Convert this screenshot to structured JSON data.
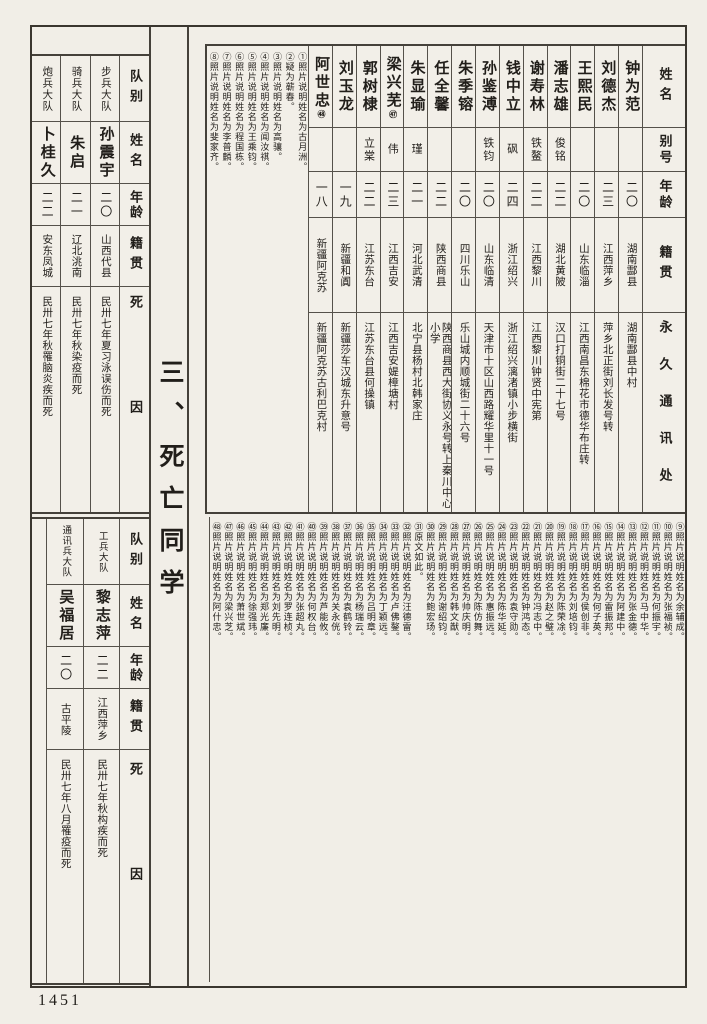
{
  "page": {
    "section_title": "三、死亡同学",
    "page_number": "1451"
  },
  "colors": {
    "paper": "#f1eee7",
    "ink": "#211e1a",
    "line": "#55514a"
  },
  "labels": {
    "name": "姓名",
    "alias": "别号",
    "age": "年龄",
    "native": "籍贯",
    "address": "永久通讯处",
    "unit": "队别",
    "cause": "死因"
  },
  "roster": {
    "persons": [
      {
        "name": "钟为范",
        "mark": "",
        "alias": "",
        "age": "二〇",
        "native": "湖南酃县",
        "address": "湖南酃县中村"
      },
      {
        "name": "刘德杰",
        "mark": "",
        "alias": "",
        "age": "二三",
        "native": "江西萍乡",
        "address": "萍乡北正街刘长发号转"
      },
      {
        "name": "王熙民",
        "mark": "",
        "alias": "",
        "age": "二〇",
        "native": "山东临淄",
        "address": "江西南昌东棉花市德华布庄转"
      },
      {
        "name": "潘志雄",
        "mark": "",
        "alias": "俊铭",
        "age": "二二",
        "native": "湖北黄陂",
        "address": "汉口打铜街二十七号"
      },
      {
        "name": "谢寿林",
        "mark": "",
        "alias": "铁鳌",
        "age": "二二",
        "native": "江西黎川",
        "address": "江西黎川钟贤中宪第"
      },
      {
        "name": "钱中立",
        "mark": "",
        "alias": "砜",
        "age": "二四",
        "native": "浙江绍兴",
        "address": "浙江绍兴漓渚镇小步横街"
      },
      {
        "name": "孙鉴溥",
        "mark": "",
        "alias": "铁钧",
        "age": "二〇",
        "native": "山东临清",
        "address": "天津市十区山西路耀华里十一号"
      },
      {
        "name": "朱季镕",
        "mark": "",
        "alias": "",
        "age": "二〇",
        "native": "四川乐山",
        "address": "乐山城内顺城街二十六号"
      },
      {
        "name": "任全馨",
        "mark": "",
        "alias": "",
        "age": "二二",
        "native": "陕西商县",
        "address": "陕西商县西大街协义永号转上秦川中心小学"
      },
      {
        "name": "朱显瑜",
        "mark": "",
        "alias": "瑾",
        "age": "二一",
        "native": "河北武清",
        "address": "北宁县杨村北韩家庄"
      },
      {
        "name": "梁兴芜",
        "mark": "㊼",
        "alias": "伟",
        "age": "二三",
        "native": "江西吉安",
        "address": "江西吉安媞樟塘村"
      },
      {
        "name": "郭树棣",
        "mark": "",
        "alias": "立棠",
        "age": "二二",
        "native": "江苏东台",
        "address": "江苏东台县何操镇"
      },
      {
        "name": "刘玉龙",
        "mark": "",
        "alias": "",
        "age": "一九",
        "native": "新疆和阗",
        "address": "新疆莎车汉城东升意号"
      },
      {
        "name": "阿世忠",
        "mark": "㊽",
        "alias": "",
        "age": "一八",
        "native": "新疆阿克苏",
        "address": "新疆阿克苏古利巴克村"
      }
    ]
  },
  "top_left_table": {
    "rows": [
      {
        "unit": "步兵大队",
        "name": "孙震宇",
        "age": "二〇",
        "native": "山西代县",
        "cause": "民卅七年夏习泳误伤而死"
      },
      {
        "unit": "骑兵大队",
        "name": "朱启",
        "age": "二一",
        "native": "辽北洮南",
        "cause": "民卅七年秋染疫而死"
      },
      {
        "unit": "炮兵大队",
        "name": "卜桂久",
        "age": "二二",
        "native": "安东凤城",
        "cause": "民卅七年秋罹脑炎疾而死"
      }
    ]
  },
  "bottom_left_table": {
    "rows": [
      {
        "unit": "工兵大队",
        "name": "黎志萍",
        "age": "二二",
        "native": "江西萍乡",
        "cause": "民卅七年秋构疾而死"
      },
      {
        "unit": "通讯兵大队",
        "name": "吴福居",
        "age": "二〇",
        "native": "古平陵",
        "cause": "民卅七年八月罹疫而死"
      }
    ]
  },
  "notes_top": [
    {
      "label": "①照片说明姓名为古月洲。"
    },
    {
      "label": "②疑为蕲春。"
    },
    {
      "label": "③照片说明姓名为高骧。"
    },
    {
      "label": "④照片说明姓名为闻汝祺。"
    },
    {
      "label": "⑤照片说明姓名为王乘钧。"
    },
    {
      "label": "⑥照片说明姓名为程国栋。"
    },
    {
      "label": "⑦照片说明姓名为李普麟。"
    },
    {
      "label": "⑧照片说明姓名为斐家齐。"
    }
  ],
  "notes_bottom": [
    {
      "label": "⑨照片说明姓名为余辅成。"
    },
    {
      "label": "⑩照片说明姓名为张福祯。"
    },
    {
      "label": "⑪照片说明姓名为何振宇。"
    },
    {
      "label": "⑫照片说明姓名为马中华。"
    },
    {
      "label": "⑬照片说明姓名为张金德。"
    },
    {
      "label": "⑭照片说明姓名为阿建中。"
    },
    {
      "label": "⑮照片说明姓名为雷振邦。"
    },
    {
      "label": "⑯照片说明姓名为何子英。"
    },
    {
      "label": "⑰照片说明姓名为侯创非。"
    },
    {
      "label": "⑱照片说明姓名为刘培钧。"
    },
    {
      "label": "⑲照片说明姓名为陈荣凃。"
    },
    {
      "label": "⑳照片说明姓名为赵之璧。"
    },
    {
      "label": "㉑照片说明姓名为冯志中。"
    },
    {
      "label": "㉒照片说明姓名为钟鸿态。"
    },
    {
      "label": "㉓照片说明姓名为袁守勋。"
    },
    {
      "label": "㉔照片说明姓名为陈华延。"
    },
    {
      "label": "㉕照片说明姓名为惠振远。"
    },
    {
      "label": "㉖照片说明姓名为陈仿舞。"
    },
    {
      "label": "㉗照片说明姓名为帅庆明。"
    },
    {
      "label": "㉘照片说明姓名为韩文猷。"
    },
    {
      "label": "㉙照片说明姓名为谢绍钧。"
    },
    {
      "label": "㉚照片说明姓名为鲍宏玚。"
    },
    {
      "label": "㉛原文如此。"
    },
    {
      "label": "㉜照片说明姓名为汪德雷。"
    },
    {
      "label": "㉝照片说明姓名为卢佛鏊。"
    },
    {
      "label": "㉞照片说明姓名为丁颖远。"
    },
    {
      "label": "㉟照片说明姓名为吕明章。"
    },
    {
      "label": "㊱照片说明姓名为杨瑞云。"
    },
    {
      "label": "㊲照片说明姓名为袁鹤铃。"
    },
    {
      "label": "㊳照片说明姓名为关永侊。"
    },
    {
      "label": "㊴照片说明姓名为芦能攸。"
    },
    {
      "label": "㊵照片说明姓名为何权台。"
    },
    {
      "label": "㊶照片说明姓名为张超丸。"
    },
    {
      "label": "㊷照片说明姓名为罗连桢。"
    },
    {
      "label": "㊸照片说明姓名为刘先明。"
    },
    {
      "label": "㊹照片说明姓名为郑光廉。"
    },
    {
      "label": "㊺照片说明姓名为徐强玮。"
    },
    {
      "label": "㊻照片说明姓名为萧世斌。"
    },
    {
      "label": "㊼照片说明姓名为梁兴芝。"
    },
    {
      "label": "㊽照片说明姓名为阿什忠。"
    }
  ]
}
